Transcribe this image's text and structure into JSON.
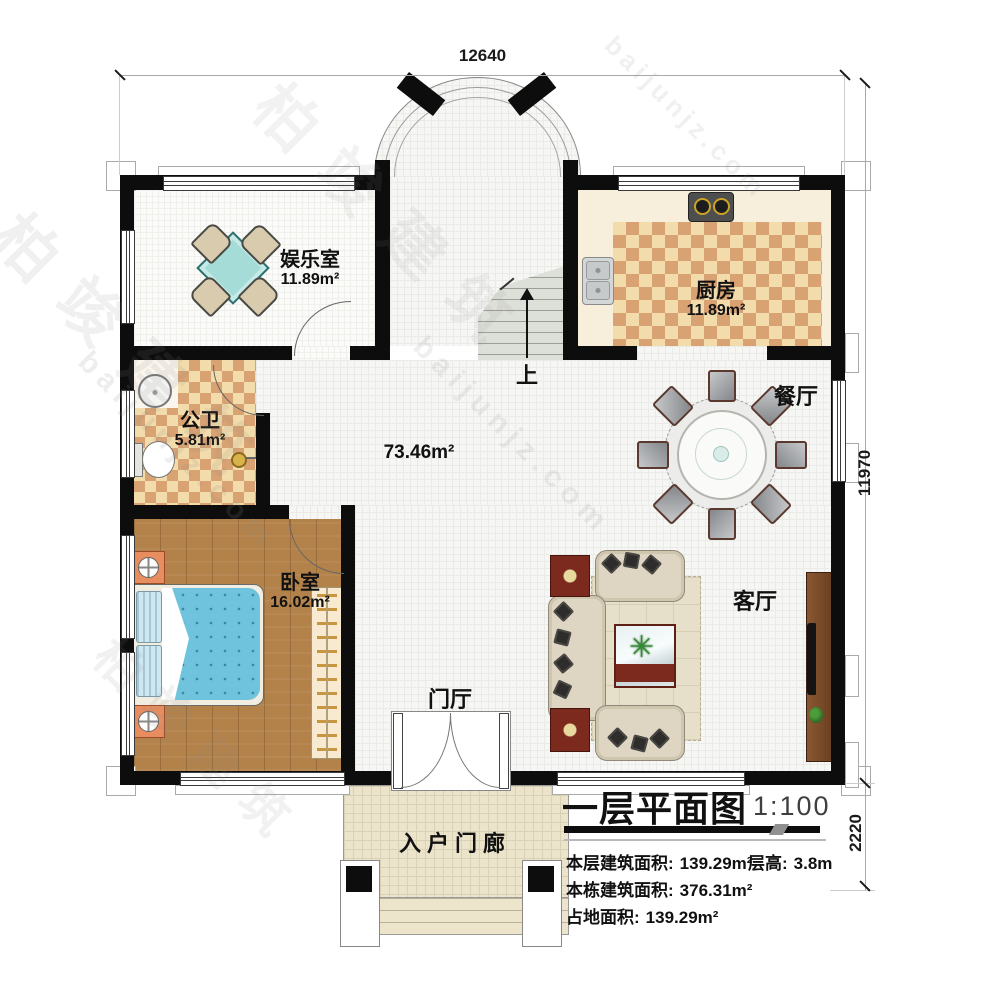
{
  "dimensions": {
    "top": "12640",
    "right": "11970",
    "right_lower": "2220"
  },
  "rooms": {
    "entertainment": {
      "name": "娱乐室",
      "area": "11.89m²"
    },
    "kitchen": {
      "name": "厨房",
      "area": "11.89m²"
    },
    "bathroom": {
      "name": "公卫",
      "area": "5.81m²"
    },
    "bedroom": {
      "name": "卧室",
      "area": "16.02m²"
    },
    "dining": {
      "name": "餐厅"
    },
    "living": {
      "name": "客厅"
    },
    "foyer": {
      "name": "门厅"
    },
    "porch": {
      "name": "入户门廊"
    },
    "hall": {
      "area": "73.46m²"
    }
  },
  "stairs": {
    "direction_label": "上"
  },
  "title_block": {
    "title": "一层平面图",
    "scale": "1:100",
    "floor_area_label": "本层建筑面积:",
    "floor_area_value": "139.29m²",
    "storey_height_label": "层高:",
    "storey_height_value": "3.8m",
    "building_area_label": "本栋建筑面积:",
    "building_area_value": "376.31m²",
    "footprint_label": "占地面积:",
    "footprint_value": "139.29m²"
  },
  "watermark": {
    "cn": "柏竣建筑",
    "en": "baijunjz.com"
  },
  "colors": {
    "wall": "#0d0d0d",
    "checker_light": "#f3dcab",
    "checker_dark": "#d8a273",
    "wood_floor": "#b3824a",
    "bed_blue": "#6fc3dc",
    "table_teal": "#a5dcd8",
    "accent_maroon": "#7b2a1d"
  }
}
